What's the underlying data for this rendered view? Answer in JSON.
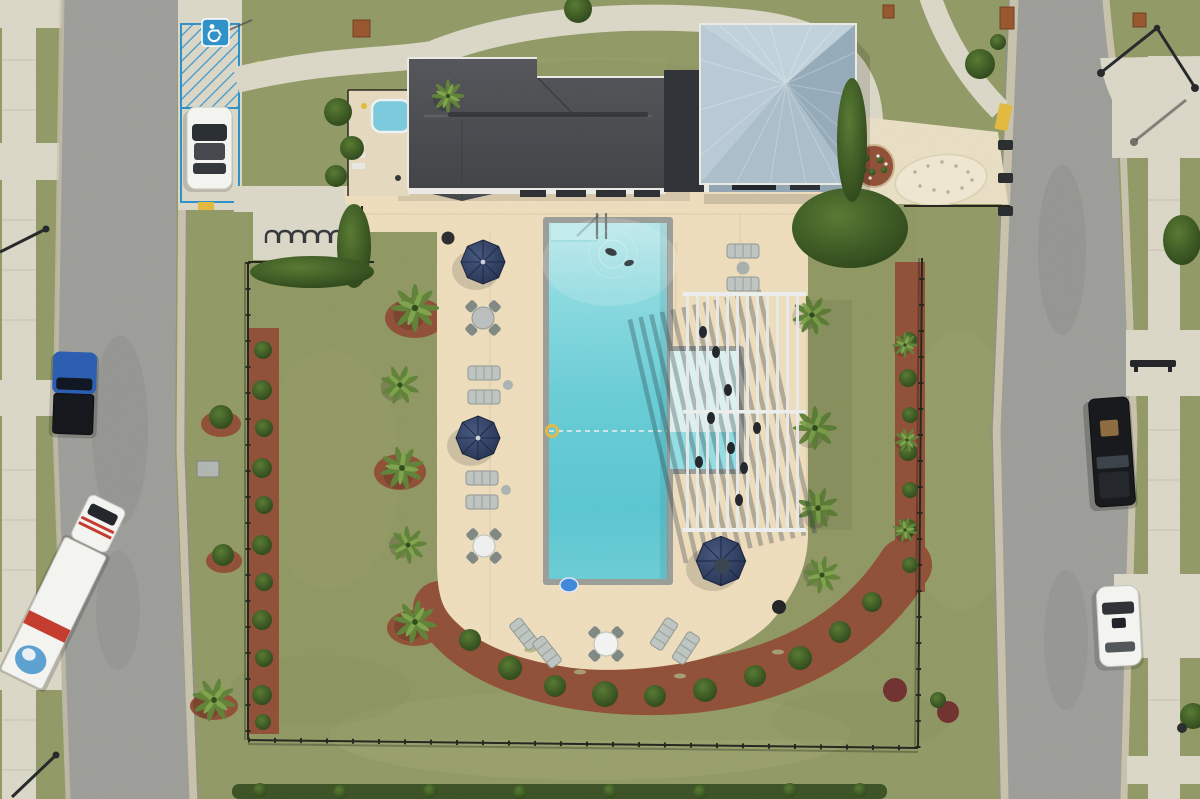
{
  "scene": {
    "type": "aerial-drone-photo",
    "description": "Top-down aerial view of a community amenity center: clubhouse with dark shingle roof, square pavilion with light blue metal hip roof, rectangular turquoise swimming pool on a cream concrete deck, slatted pergola, navy patio umbrellas, lounge chairs, black perimeter fence, lawns, red mulch landscape beds with palms and shrubs, and two residential streets with parked vehicles",
    "palette": {
      "grass": "#8f9765",
      "grassLight": "#aaae7c",
      "grassDark": "#75814e",
      "asphalt": "#9b9b97",
      "gutter": "#c7c0aa",
      "curb": "#8e8e86",
      "walk": "#dad6c6",
      "walkJoint": "#c0bbaa",
      "deck": "#eddcbb",
      "deckJoint": "#d8c6a0",
      "plaza": "#e8ddc3",
      "pad": "#eee6cf",
      "mulch": "#8e4f38",
      "hedge": "#33491f",
      "shrubLight": "#567832",
      "shrubDark": "#2b421a",
      "palmLight": "#7da14c",
      "palm": "#5f8038",
      "palmCore": "#314c1d",
      "roof": "#4a4b50",
      "roofRidge": "#5d5e63",
      "fascia": "#eae9e4",
      "connector": "#2f3337",
      "pavN": "#c0d1db",
      "pavE": "#93a9b8",
      "pavS": "#a9bdca",
      "pavW": "#b7c9d5",
      "pavWall": "#8fa3b1",
      "coping": "#989b96",
      "waterTop": "#b4eaee",
      "waterMid": "#60ccd7",
      "waterDeep": "#52c5d2",
      "shelfTop": "#ddf4f5",
      "shelfLow": "#8fdee6",
      "fence": "#26261f",
      "umbA": "#45567c",
      "umbB": "#222e4c",
      "furn": "#bdc4c0",
      "chair": "#7e8682",
      "hcBlue": "#2f8fc6",
      "yellow": "#e2b83f",
      "white": "#f3f3f0",
      "truckRed": "#c23b2e",
      "truckBlue": "#5b9fd0",
      "pickupBlue": "#2a5cb0",
      "darkV": "#17191d",
      "maroon": "#6e3230"
    },
    "inventory": {
      "pool": "rectangular pool with tanning shelf, entry steps, safety rope and yellow ring buoy",
      "swimmers": 2,
      "umbrellas": 3,
      "table_sets": 3,
      "loungers": 11,
      "bike_racks": 6,
      "pergola": "white slatted shade pergola with people beneath",
      "spa": "small blue spa in equipment yard",
      "handicap_space": "blue hatched accessible parking stall with wheelchair sign"
    },
    "vehicles": [
      {
        "name": "white-car-handicap-space",
        "color": "#f3f3f0"
      },
      {
        "name": "blue-pickup-truck",
        "color": "#2a5cb0"
      },
      {
        "name": "white-moving-box-truck",
        "color": "#f3f3f0",
        "stripe": "#c23b2e",
        "graphic": "#5b9fd0"
      },
      {
        "name": "black-pickup-truck",
        "color": "#17191d"
      },
      {
        "name": "white-sedan",
        "color": "#f3f3f0"
      }
    ]
  }
}
